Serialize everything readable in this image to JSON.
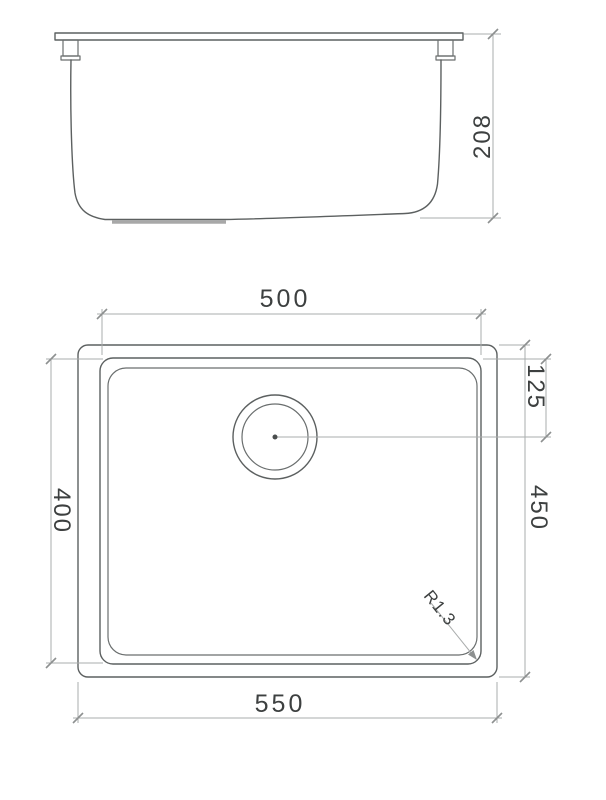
{
  "dimensions": {
    "side_height": "208",
    "bowl_width": "500",
    "drain_offset": "125",
    "bowl_height": "400",
    "overall_height": "450",
    "overall_width": "550",
    "corner_radius": "R1.3"
  }
}
